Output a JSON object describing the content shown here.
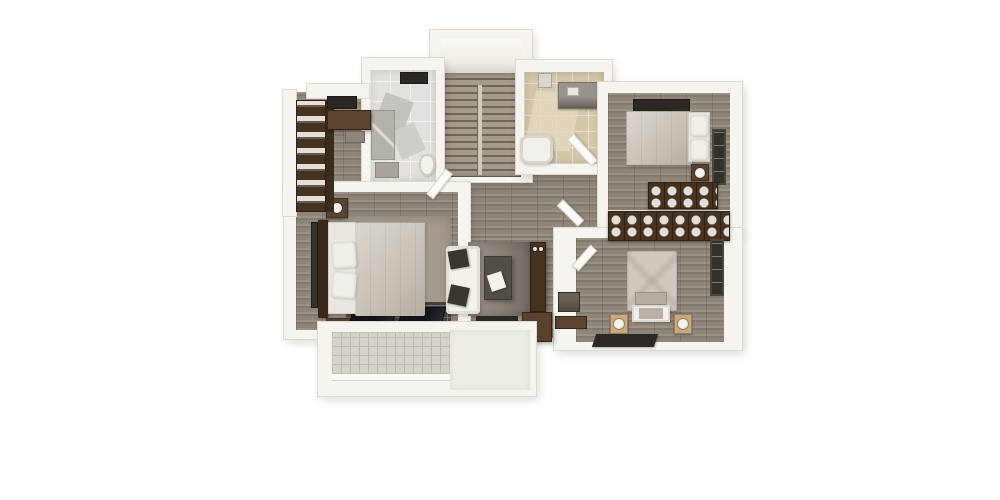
{
  "scene": {
    "type": "3d-floorplan-render",
    "description": "Top-down 3D rendering of an upper-floor apartment plan: staircase, two bathrooms, three bedrooms, walk-in closet, lounge nook and balcony on gray wood flooring, white background, no text labels",
    "background": "#ffffff"
  },
  "palette": {
    "bg": "#ffffff",
    "wall": "#f6f4ef",
    "wall_edge": "#ddd9d1",
    "wall_bright": "#fdfcfa",
    "wood_mid": "#8f8679",
    "rug_light": "#a49b8e",
    "rug_gray": "#8a837a",
    "dark_rug": "#2c2925",
    "skylight": "#2b2823",
    "glass_dark": "#34302a",
    "furniture_wood": "#46321f",
    "furniture_wood_light": "#5a442f",
    "towel": "#e4e0d7",
    "bedding": "#c9c3b9",
    "pillow": "#f1efe9",
    "sofa": "#f3f1ec",
    "cushion_dark": "#3a362f",
    "table_dark": "#514d47",
    "tile_left": "#e2e1dd",
    "tile_left_accent": "#b7b5b0",
    "tile_right": "#d5c8aa",
    "tile_right_light": "#e4dac0",
    "balcony_tile": "#d5d3ca",
    "balcony_grid": "#bcb9af",
    "stair_light": "#a59c8e",
    "stair_dark": "#6f6759",
    "lamp": "#f5f3ee",
    "gray_box": "#8d857a",
    "dresser": "#4e463c"
  },
  "rooms": [
    {
      "id": "staircase",
      "features": [
        "landing",
        "wood-steps",
        "handrail"
      ]
    },
    {
      "id": "bathroom-left",
      "features": [
        "skylight",
        "shower",
        "vanity",
        "toilet",
        "white-tile-floor"
      ]
    },
    {
      "id": "bathroom-right",
      "features": [
        "sink",
        "vanity",
        "bathtub",
        "open-door",
        "beige-tile-floor"
      ]
    },
    {
      "id": "bedroom-top-right",
      "features": [
        "skylight",
        "double-bed",
        "pillows",
        "nightstand-with-lamp",
        "window",
        "linen-cubby-wardrobe"
      ]
    },
    {
      "id": "bedroom-bottom-right",
      "features": [
        "linen-cubby-wardrobe",
        "double-bed",
        "foot-bench",
        "two-nightstands-with-lamps",
        "dark-rug",
        "dresser",
        "sideboard",
        "window"
      ]
    },
    {
      "id": "master-bedroom",
      "features": [
        "double-bed",
        "headboard",
        "two-nightstands-with-lamps",
        "pillows",
        "area-rug",
        "dark-glass-band",
        "left-windows"
      ]
    },
    {
      "id": "walk-in-closet",
      "features": [
        "linen-shelving",
        "wardrobe-cabinet",
        "storage-box",
        "skylight"
      ]
    },
    {
      "id": "lounge-nook",
      "features": [
        "sofa",
        "two-dark-cushions",
        "coffee-table",
        "area-rug",
        "tall-cabinet-with-knobs",
        "low-cabinet",
        "dark-runner"
      ]
    },
    {
      "id": "hallway",
      "features": [
        "wood-plank-floor",
        "open-doors"
      ]
    },
    {
      "id": "balcony",
      "features": [
        "tiled-floor",
        "white-railing"
      ]
    }
  ]
}
